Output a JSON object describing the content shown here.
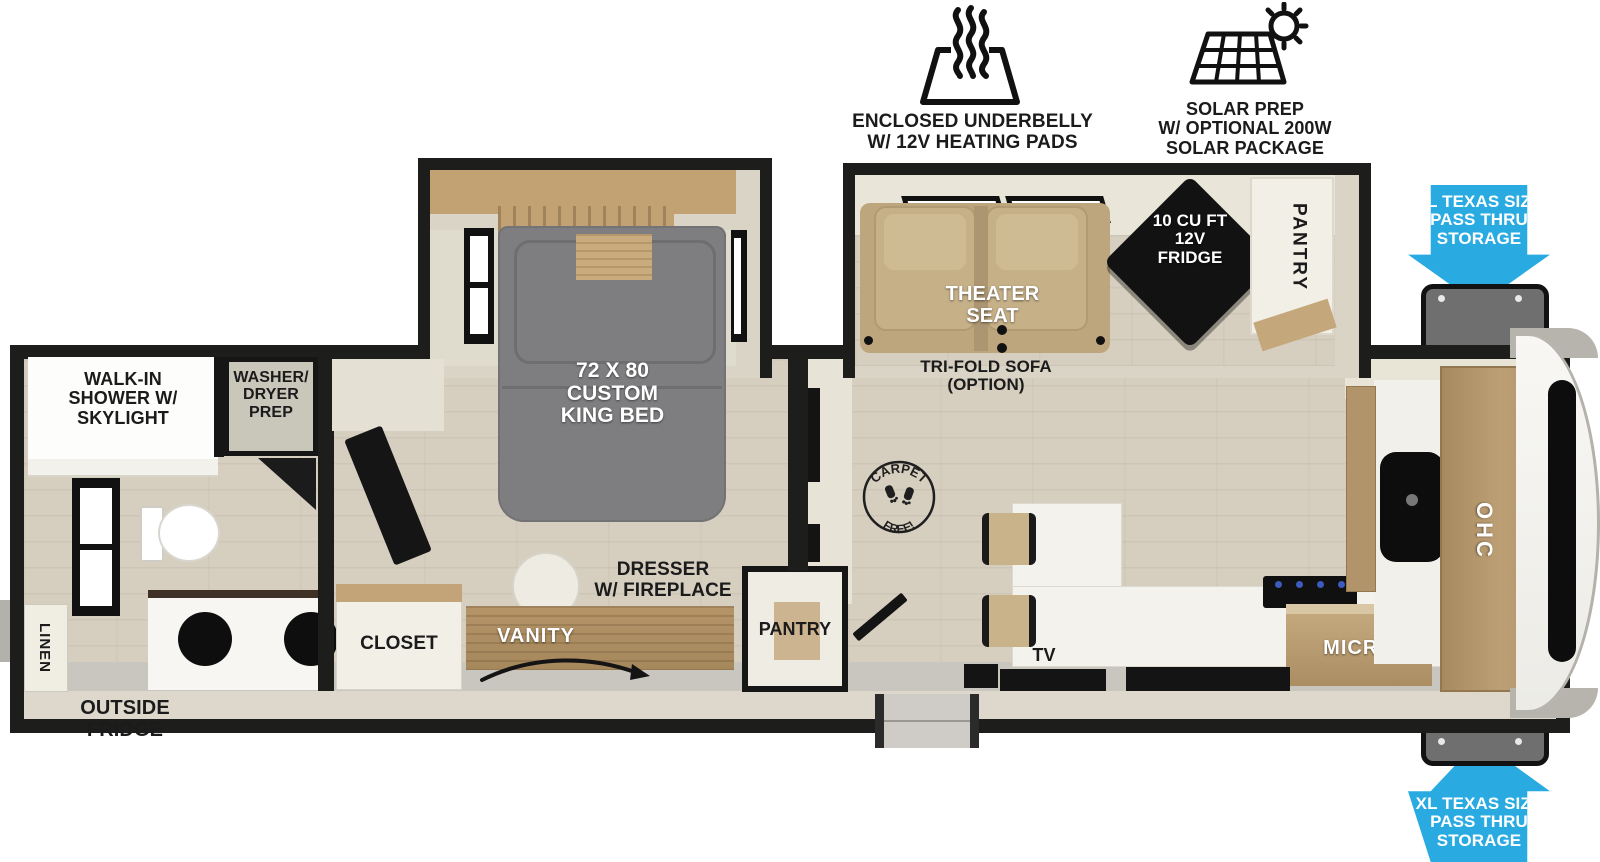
{
  "features": {
    "underbelly": {
      "icon": "heat-waves-icon",
      "lines": [
        "ENCLOSED UNDERBELLY",
        "W/ 12V HEATING PADS"
      ]
    },
    "solar": {
      "icon": "solar-panel-sun-icon",
      "lines": [
        "SOLAR PREP",
        "W/ OPTIONAL 200W",
        "SOLAR PACKAGE"
      ]
    }
  },
  "storage": {
    "arrow_color": "#29ABE2",
    "top_label": [
      "XL TEXAS SIZE",
      "PASS THRU",
      "STORAGE"
    ],
    "bottom_label": [
      "XL TEXAS SIZE",
      "PASS THRU",
      "STORAGE"
    ]
  },
  "exterior": {
    "outside_fridge": [
      "OUTSIDE",
      "FRIDGE"
    ]
  },
  "bathroom": {
    "shower": [
      "WALK-IN",
      "SHOWER W/",
      "SKYLIGHT"
    ],
    "washer_dryer": [
      "WASHER/",
      "DRYER",
      "PREP"
    ],
    "linen": "LINEN"
  },
  "bedroom": {
    "bed": [
      "72 X 80",
      "CUSTOM",
      "KING BED"
    ],
    "closet": "CLOSET",
    "vanity": "VANITY",
    "dresser": [
      "DRESSER",
      "W/ FIREPLACE"
    ]
  },
  "hall": {
    "pantry": "PANTRY"
  },
  "living": {
    "theater_seat": [
      "THEATER",
      "SEAT"
    ],
    "sofa_option": [
      "TRI-FOLD SOFA",
      "(OPTION)"
    ],
    "fridge": [
      "10 CU FT",
      "12V",
      "FRIDGE"
    ],
    "pantry": "PANTRY",
    "carpet_badge": {
      "top": "CARPET",
      "bottom": "FREE!"
    },
    "tv": "TV"
  },
  "kitchen": {
    "micro": "MICRO",
    "ohc": "OHC"
  },
  "colors": {
    "arrow_blue": "#29ABE2",
    "wall_black": "#1D1D1B",
    "floor_wood": "#D6CFC0",
    "slide_wood": "#C2A173",
    "bed_gray": "#7E7E80",
    "seat_tan": "#C1AA82",
    "cabinet_wood": "#B2946B",
    "counter_white": "#F4F2EC",
    "appliance_black": "#141414",
    "storage_gray": "#6F6F6F"
  }
}
